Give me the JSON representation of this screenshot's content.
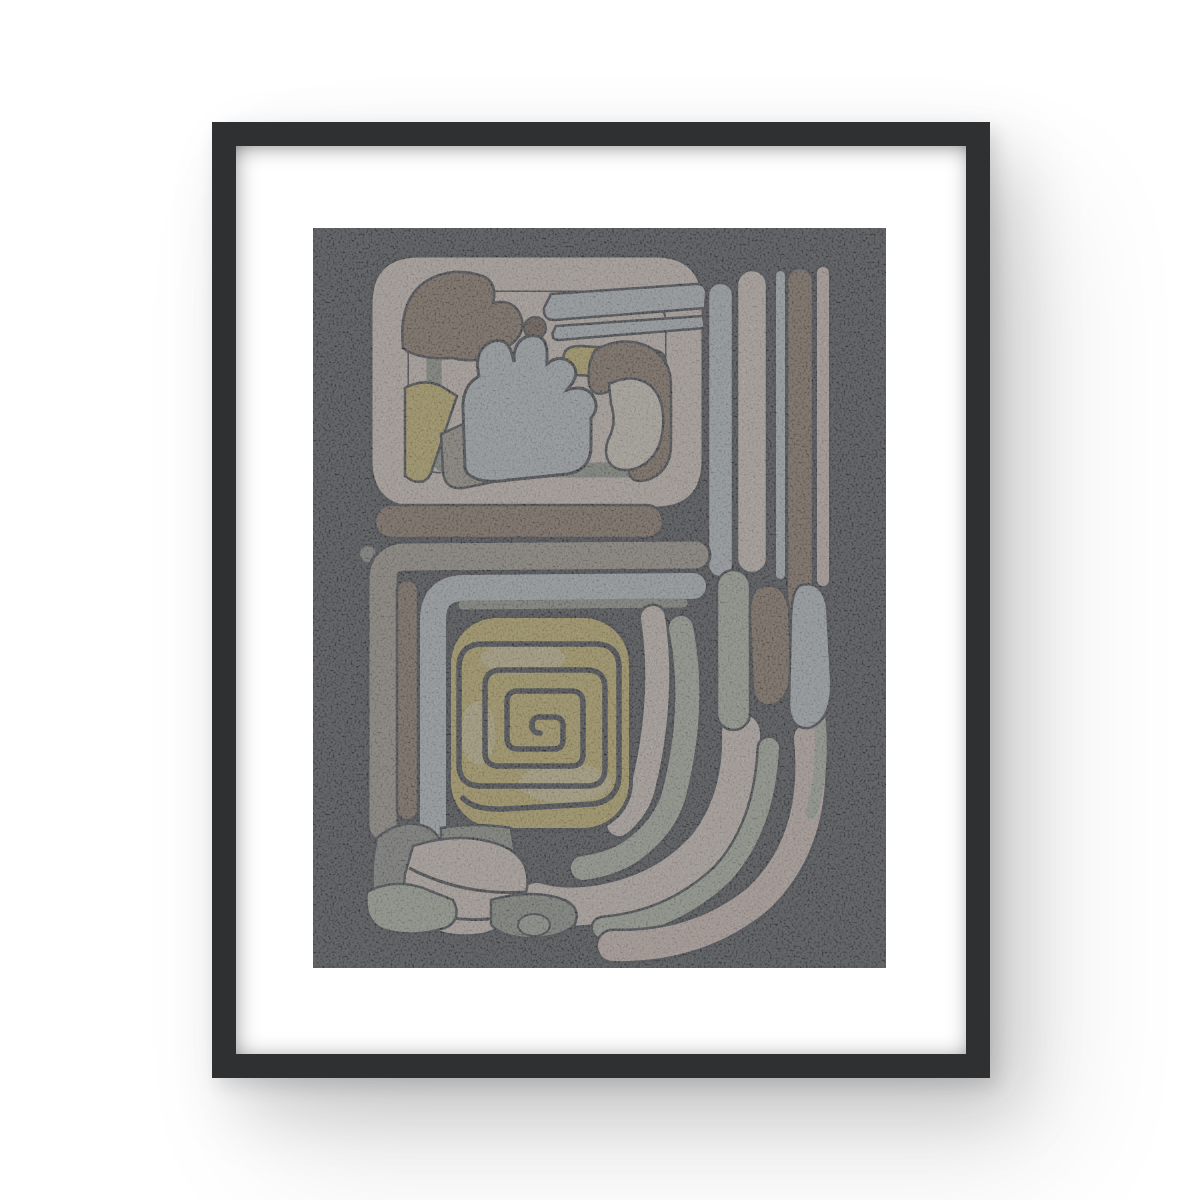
{
  "scene": {
    "type": "framed poster product photo on white wall",
    "background_color": "#ffffff",
    "frame": {
      "color": "#2e3032",
      "style": "thin black frame, portrait orientation",
      "shadow": "soft gray drop shadow to lower right"
    },
    "mat": {
      "color": "#ffffff",
      "style": "wide white mat border"
    },
    "artwork": {
      "title": "Abstract composition in pre-Columbian glyph style",
      "background_color": "#3d4048",
      "texture": "speckled grainy print",
      "motifs": [
        "upper glyph block with pink ring border and cloud shape",
        "light-blue cloud shape with finger bumps",
        "yellow rounded-square with dark square spiral",
        "vertical stripe column on right (blue, pink, brown bars)",
        "brown and blue teardrop shapes",
        "nested curved pastel bands sweeping to bottom right",
        "pebble blobs at bottom left",
        "small dots and circles accents"
      ],
      "palette": {
        "charcoal": "#3d4048",
        "outline": "#343740",
        "pink": "#e8d7ce",
        "blush": "#e3cec5",
        "cream": "#ebe0d2",
        "blue": "#c5cfd6",
        "yellow": "#d5c068",
        "yellowpale": "#e6d9a8",
        "brown": "#87705f",
        "browndark": "#6b5347",
        "taupe": "#a69c90",
        "sage": "#b6c1af",
        "sagedark": "#939b8c",
        "gray": "#8e928b",
        "graylight": "#aab3a6"
      }
    }
  }
}
